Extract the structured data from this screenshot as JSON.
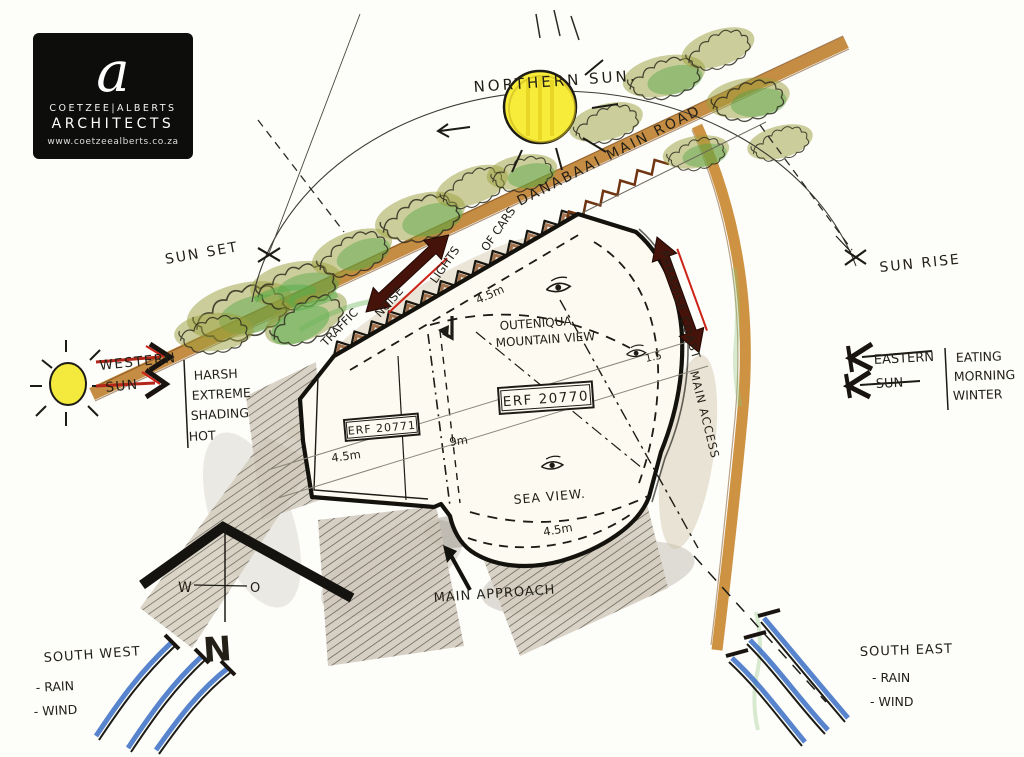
{
  "logo": {
    "letter": "a",
    "firm": "COETZEE|ALBERTS",
    "type": "ARCHITECTS",
    "site": "www.coetzeealberts.co.za"
  },
  "sun": {
    "northern": "NORTHERN SUN.",
    "sunset": "SUN SET",
    "sunrise": "SUN RISE"
  },
  "west": {
    "line1": "WESTERN",
    "line2": "SUN",
    "note1": "HARSH",
    "note2": "EXTREME",
    "note3": "SHADING",
    "note4": "HOT"
  },
  "east": {
    "line1": "EASTERN",
    "line2": "SUN",
    "note1": "EATING",
    "note2": "MORNING",
    "note3": "WINTER"
  },
  "road": {
    "name": "DANABAAI MAIN ROAD",
    "traffic": "TRAFFIC",
    "noise": "NOISE",
    "lights": "LIGHTS",
    "of_cars": "OF CARS"
  },
  "access": {
    "line1": "PARADISE COAST",
    "line2": "MAIN ACCESS"
  },
  "site": {
    "erf_main": "ERF 20770",
    "erf_adj": "ERF 20771",
    "mountain1": "OUTENIQUA",
    "mountain2": "MOUNTAIN VIEW",
    "sea": "SEA VIEW.",
    "approach": "MAIN APPROACH",
    "dim_45": "4.5m",
    "dim_9": "9m",
    "dim_15": "1.5"
  },
  "compass": {
    "w": "W",
    "o": "O",
    "n": "N"
  },
  "wind_sw": {
    "title": "SOUTH WEST",
    "rain": "- RAIN",
    "wind": "- WIND"
  },
  "wind_se": {
    "title": "SOUTH EAST",
    "rain": "- RAIN",
    "wind": "- WIND"
  },
  "colors": {
    "road_brown": "#c08030",
    "arrow_maroon": "#451309",
    "arrow_red": "#cc2218",
    "sun_yellow": "#f7ec3a",
    "veg_olive": "#9aa03c",
    "veg_green": "#55a348",
    "wind_blue": "#3a6fc4",
    "ink": "#1d1b15"
  }
}
